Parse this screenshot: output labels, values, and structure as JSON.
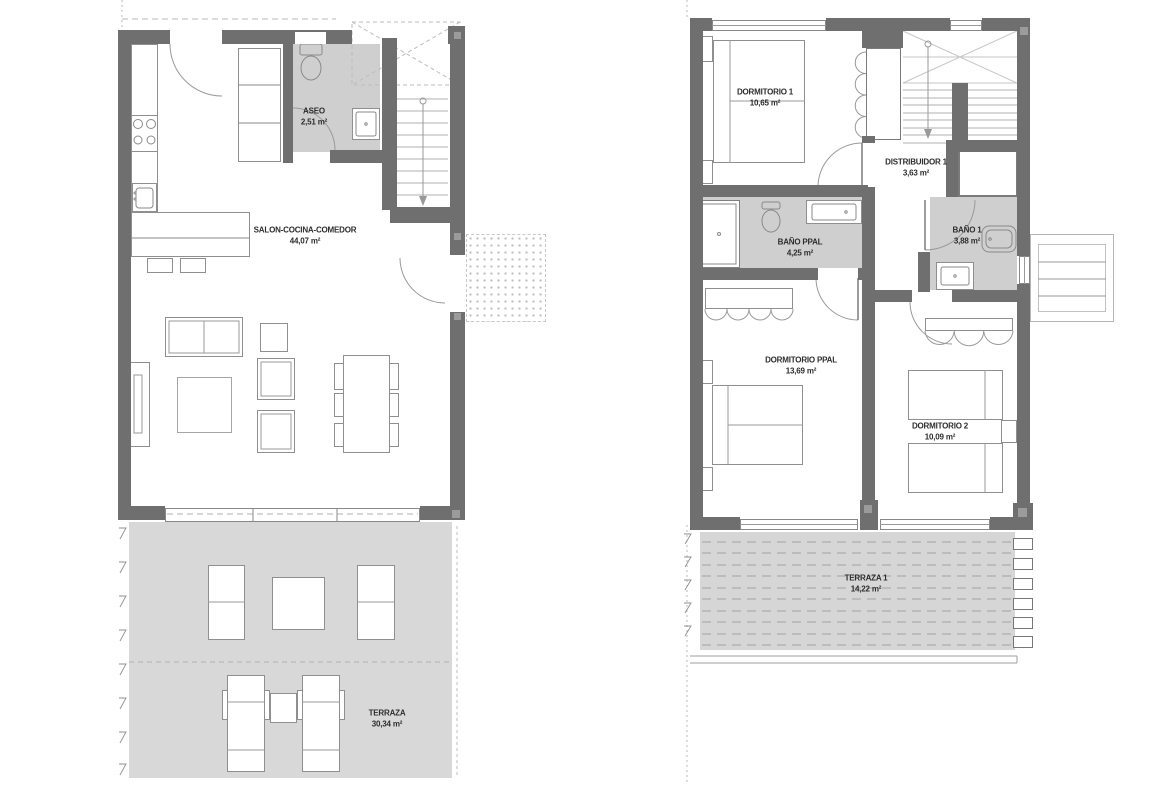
{
  "document": {
    "title": "Plano de vivienda - dos plantas"
  },
  "plans": [
    {
      "name": "planta-baja",
      "rooms": [
        {
          "label": "ASEO",
          "area": "2,51 m²"
        },
        {
          "label": "SALON-COCINA-COMEDOR",
          "area": "44,07 m²"
        },
        {
          "label": "TERRAZA",
          "area": "30,34 m²"
        }
      ]
    },
    {
      "name": "planta-primera",
      "rooms": [
        {
          "label": "DORMITORIO 1",
          "area": "10,65 m²"
        },
        {
          "label": "DISTRIBUIDOR 1",
          "area": "3,63 m²"
        },
        {
          "label": "BAÑO PPAL",
          "area": "4,25 m²"
        },
        {
          "label": "BAÑO 1",
          "area": "3,88 m²"
        },
        {
          "label": "DORMITORIO PPAL",
          "area": "13,69 m²"
        },
        {
          "label": "DORMITORIO 2",
          "area": "10,09 m²"
        },
        {
          "label": "TERRAZA 1",
          "area": "14,22 m²"
        }
      ]
    }
  ],
  "colors": {
    "wall": "#6f6f6f",
    "bath_floor": "#cfcfcf",
    "terrace_floor": "#d8d8d8",
    "line": "#9a9a9a",
    "text": "#2d2d2d"
  }
}
